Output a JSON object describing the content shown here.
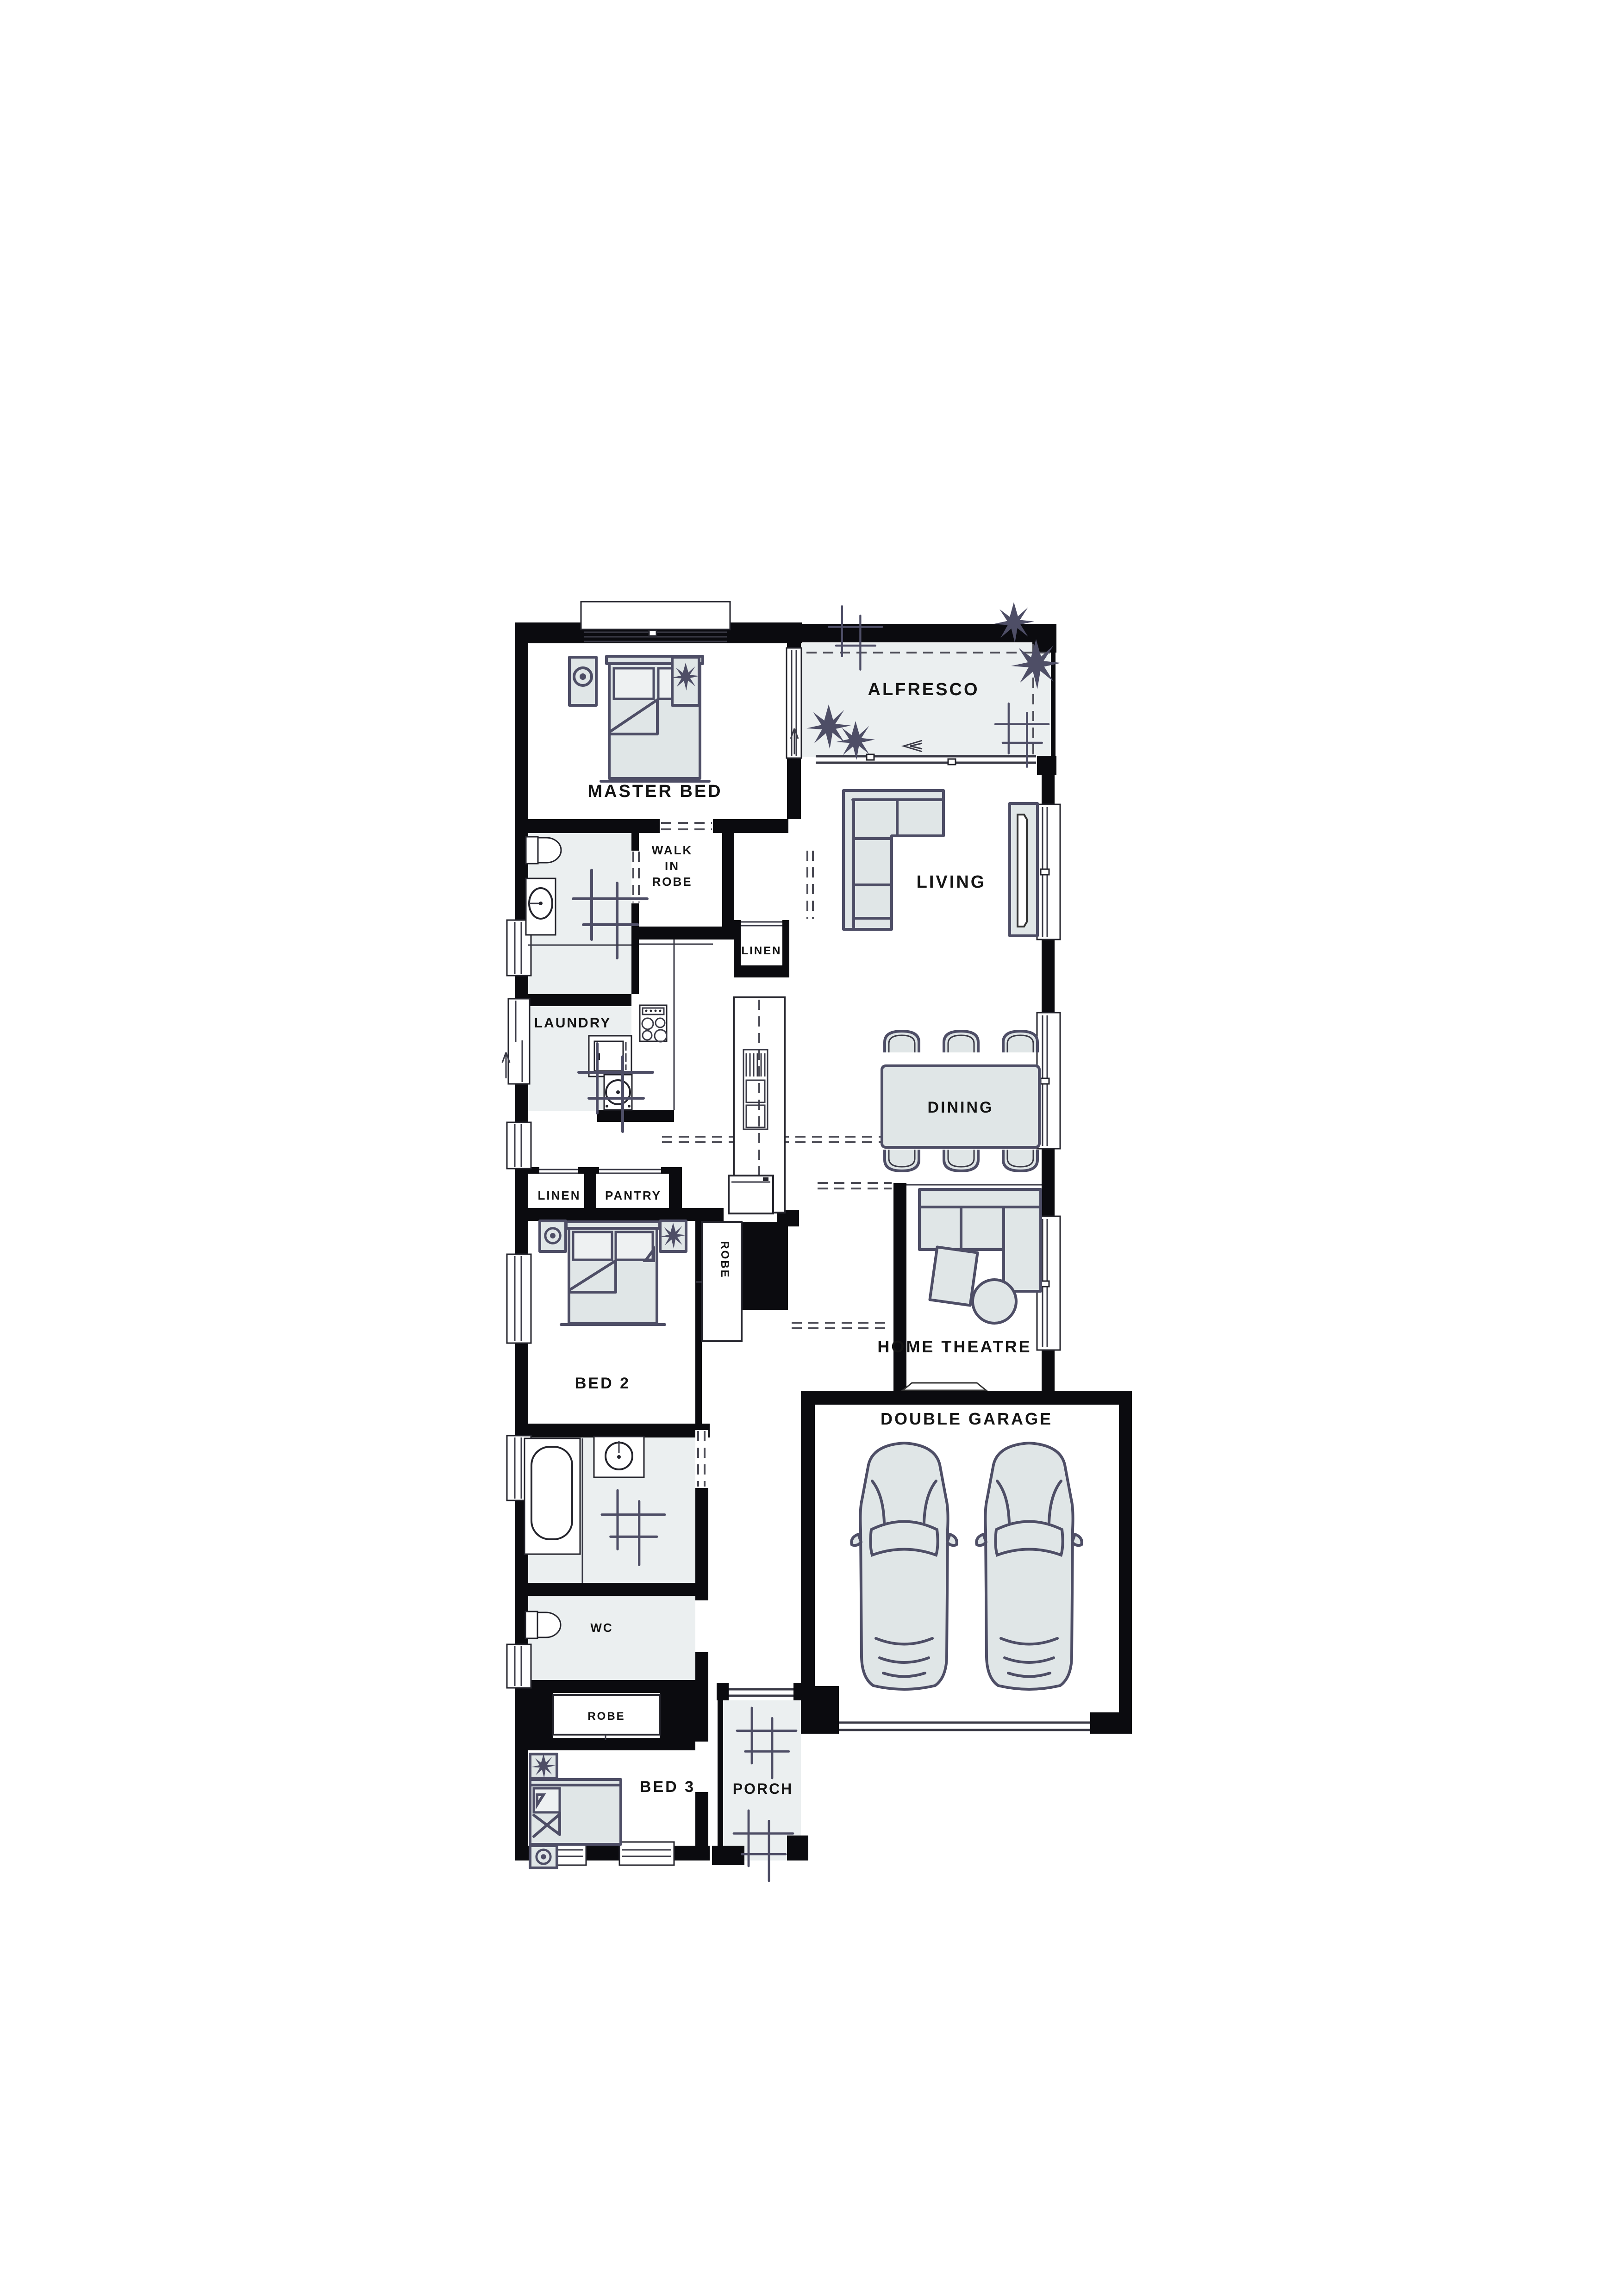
{
  "plan": {
    "colors": {
      "wall": "#0b0b0f",
      "room_tint": "#ebeff0",
      "furniture_fill": "#e0e6e7",
      "furniture_stroke": "#4e4e66",
      "label": "#141414",
      "background": "#ffffff"
    },
    "rooms": {
      "master_bed": {
        "label": "MASTER BED"
      },
      "alfresco": {
        "label": "ALFRESCO"
      },
      "walk_in_robe": {
        "line1": "WALK",
        "line2": "IN",
        "line3": "ROBE"
      },
      "linen_hall": {
        "label": "LINEN"
      },
      "living": {
        "label": "LIVING"
      },
      "laundry": {
        "label": "LAUNDRY"
      },
      "dining": {
        "label": "DINING"
      },
      "linen": {
        "label": "LINEN"
      },
      "pantry": {
        "label": "PANTRY"
      },
      "bed2": {
        "label": "BED 2"
      },
      "robe_bed2": {
        "label": "ROBE"
      },
      "home_theatre": {
        "label": "HOME THEATRE"
      },
      "double_garage": {
        "label": "DOUBLE GARAGE"
      },
      "wc": {
        "label": "WC"
      },
      "robe_bed3": {
        "label": "ROBE"
      },
      "bed3": {
        "label": "BED 3"
      },
      "porch": {
        "label": "PORCH"
      }
    }
  }
}
